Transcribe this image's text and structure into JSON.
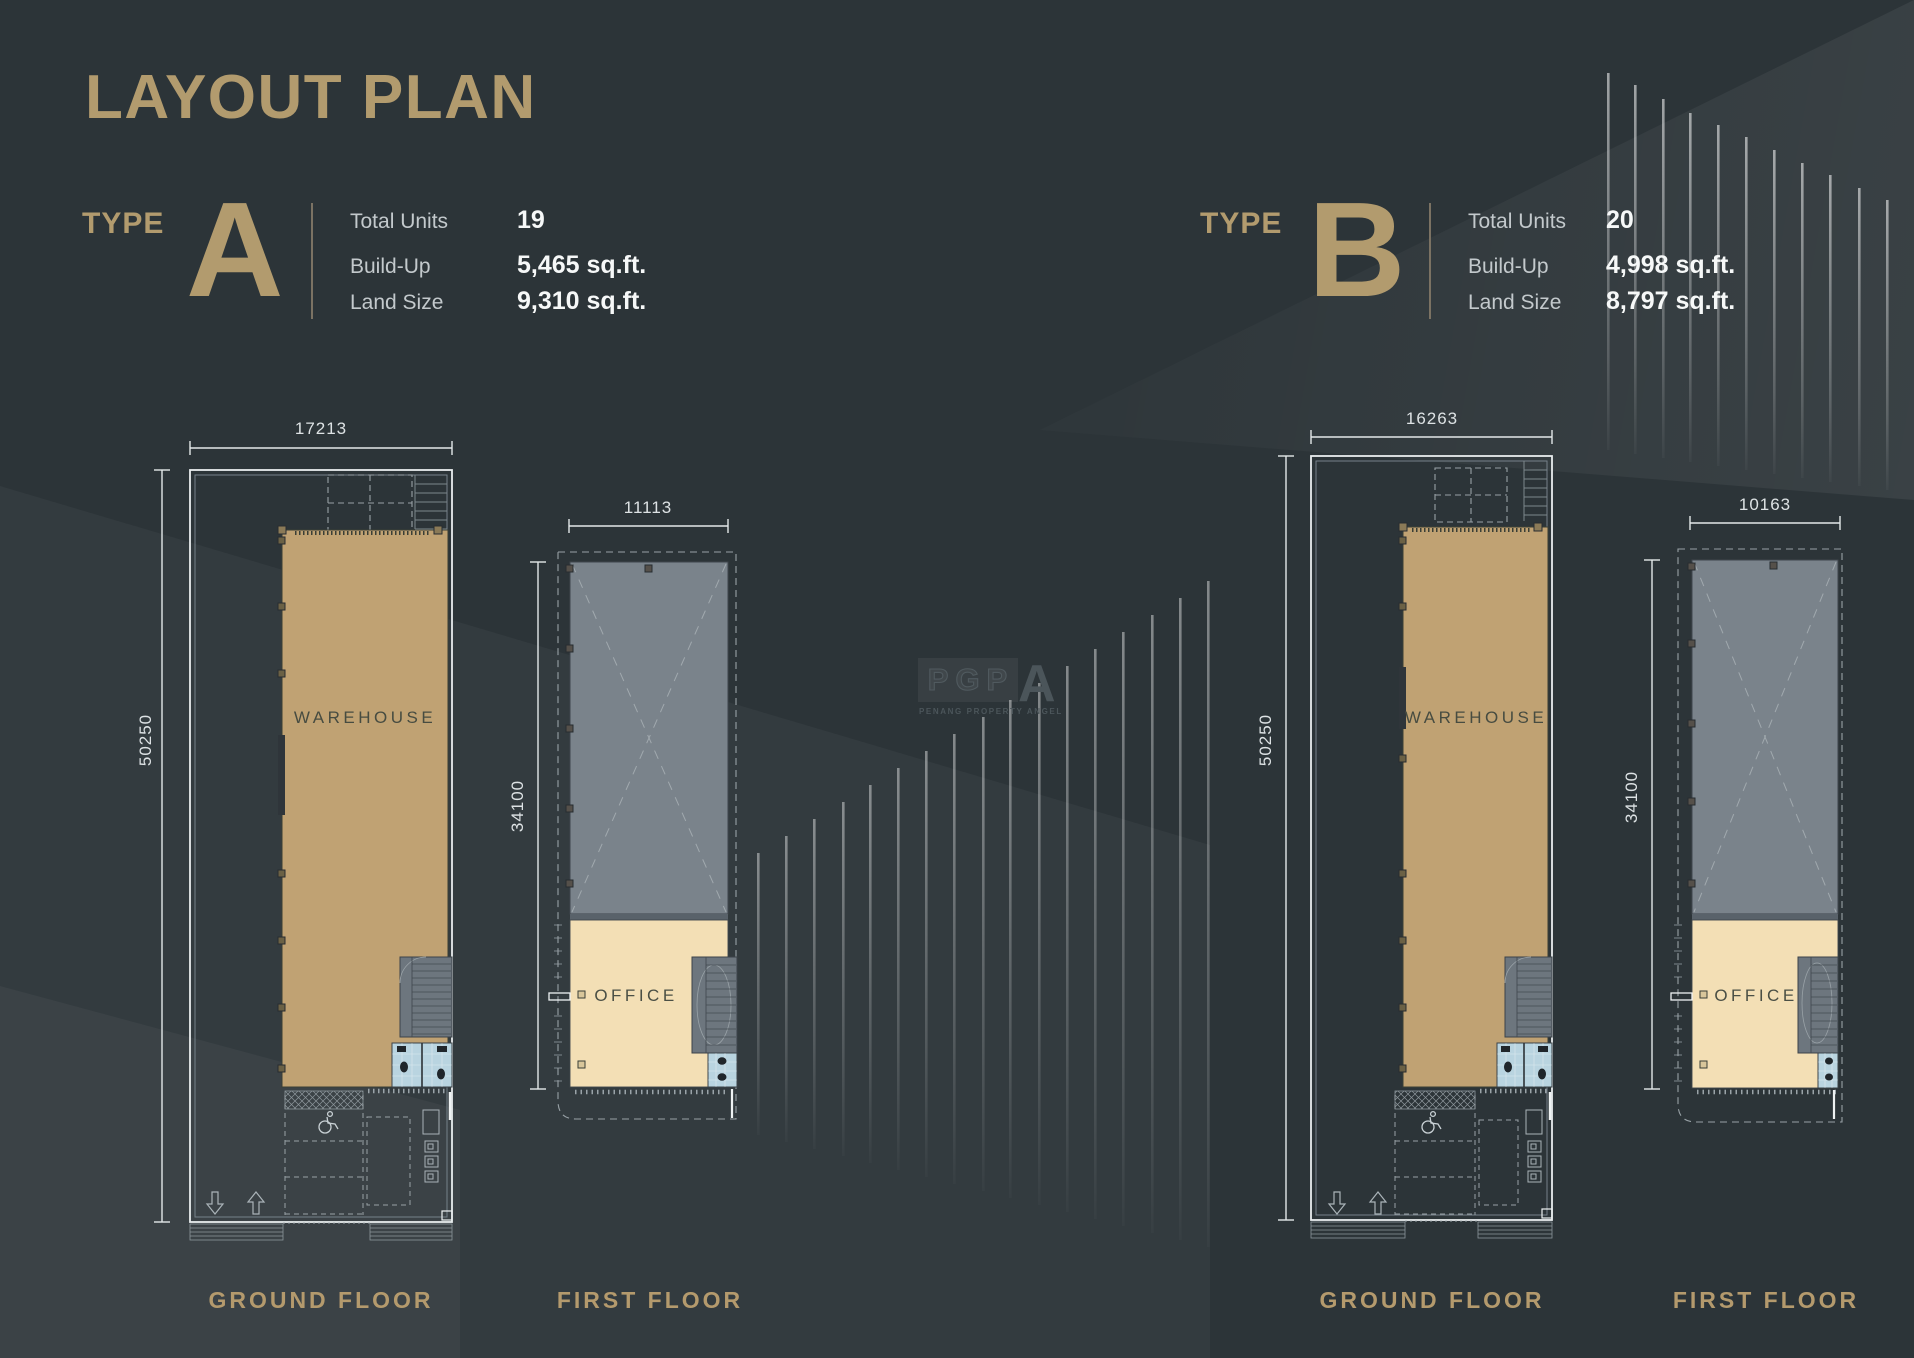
{
  "title": "LAYOUT PLAN",
  "types": [
    {
      "type_word": "TYPE",
      "letter": "A",
      "stats": [
        {
          "label": "Total Units",
          "value": "19"
        },
        {
          "label": "Build-Up",
          "value": "5,465 sq.ft."
        },
        {
          "label": "Land Size",
          "value": "9,310 sq.ft."
        }
      ],
      "ground_floor": {
        "label": "GROUND FLOOR",
        "room_label": "WAREHOUSE",
        "width_dim": "17213",
        "depth_dim": "50250"
      },
      "first_floor": {
        "label": "FIRST FLOOR",
        "room_label": "OFFICE",
        "width_dim": "11113",
        "depth_dim": "34100"
      }
    },
    {
      "type_word": "TYPE",
      "letter": "B",
      "stats": [
        {
          "label": "Total Units",
          "value": "20"
        },
        {
          "label": "Build-Up",
          "value": "4,998 sq.ft."
        },
        {
          "label": "Land Size",
          "value": "8,797 sq.ft."
        }
      ],
      "ground_floor": {
        "label": "GROUND FLOOR",
        "room_label": "WAREHOUSE",
        "width_dim": "16263",
        "depth_dim": "50250"
      },
      "first_floor": {
        "label": "FIRST FLOOR",
        "room_label": "OFFICE",
        "width_dim": "10163",
        "depth_dim": "34100"
      }
    }
  ],
  "watermark": {
    "logo_outline": "PGP",
    "logo_solid": "A",
    "tagline": "PENANG PROPERTY ANGEL"
  },
  "colors": {
    "background": "#2c3438",
    "accent_gold": "#b29b6e",
    "warehouse_fill": "#c0a273",
    "office_fill": "#f3dfb5",
    "roof_fill": "#7a838b",
    "toilet_fill": "#b9d4e0",
    "dimension_line": "#e3e8e9",
    "stat_label_gray": "#c3c9cc",
    "stat_value_white": "#f6f8f8"
  }
}
